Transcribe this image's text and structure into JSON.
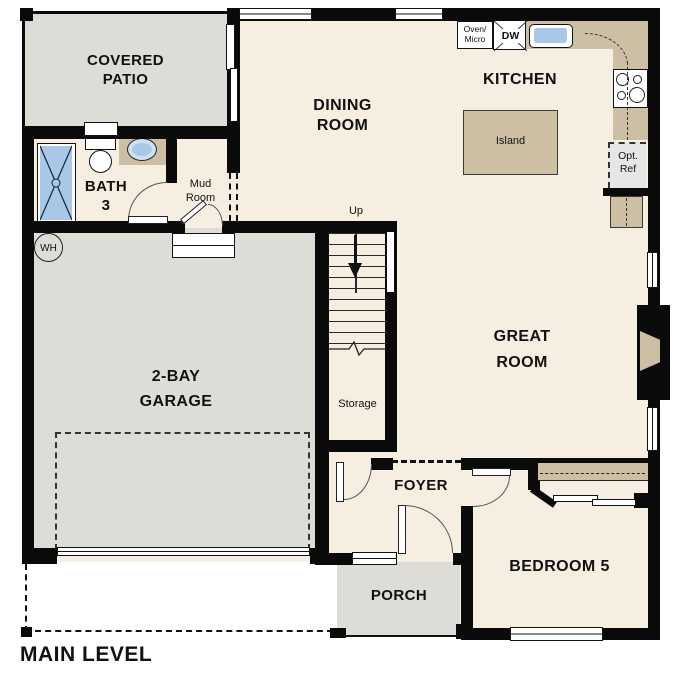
{
  "plan": {
    "title": "MAIN LEVEL",
    "labels": {
      "covered_patio_1": "COVERED",
      "covered_patio_2": "PATIO",
      "dining_1": "DINING",
      "dining_2": "ROOM",
      "kitchen": "KITCHEN",
      "island": "Island",
      "bath_1": "BATH",
      "bath_2": "3",
      "mud_1": "Mud",
      "mud_2": "Room",
      "up": "Up",
      "storage": "Storage",
      "garage_1": "2-BAY",
      "garage_2": "GARAGE",
      "great_1": "GREAT",
      "great_2": "ROOM",
      "foyer": "FOYER",
      "porch": "PORCH",
      "bedroom5": "BEDROOM 5",
      "wh": "WH",
      "oven_micro_1": "Oven/",
      "oven_micro_2": "Micro",
      "dw": "DW",
      "opt_ref_1": "Opt.",
      "opt_ref_2": "Ref"
    },
    "colors": {
      "wall": "#0a0a0a",
      "floor": "#f6eee1",
      "concrete": "#dedcd7",
      "counter": "#cdbfa3",
      "fixture_blue": "#a9c8e8",
      "fixture_blue_light": "#cfe0f2",
      "optref_gray": "#e7e6e4"
    }
  }
}
